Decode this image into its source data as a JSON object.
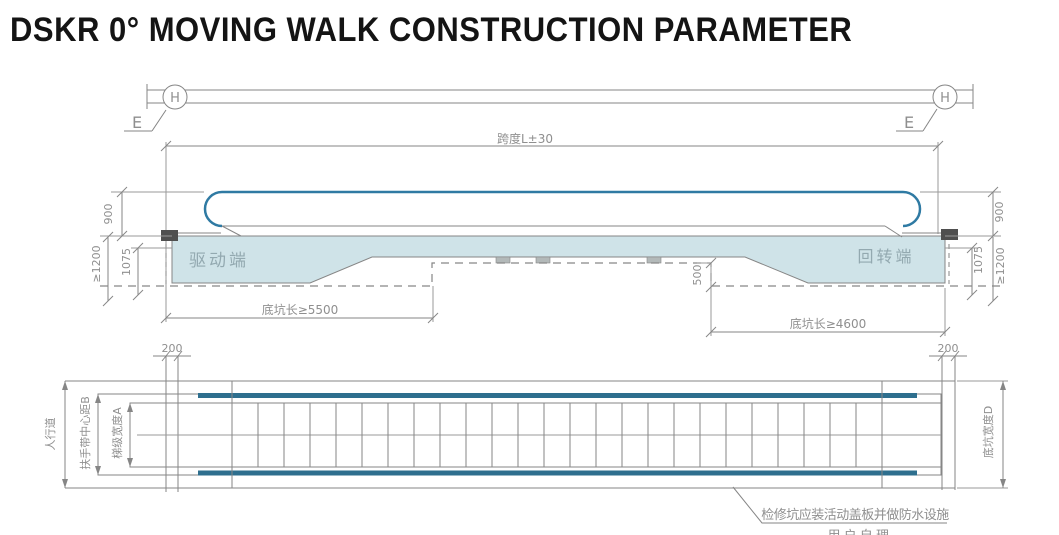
{
  "title": "DSKR 0° MOVING WALK CONSTRUCTION PARAMETER",
  "colors": {
    "line_gray": "#868686",
    "handrail_teal": "#2f7aa3",
    "truss_fill": "#cfe3e8",
    "belt_teal": "#2e6f8e",
    "cn_label_gray": "#93a9b0",
    "title_black": "#141414"
  },
  "section_view": {
    "grid_bubble_left": "H",
    "grid_bubble_right": "H",
    "elev_mark_left": "E",
    "elev_mark_right": "E",
    "span_dim": "跨度L±30",
    "handrail_height_left": "900",
    "handrail_height_right": "900",
    "pit_depth_left": "≥1200",
    "pit_depth_right": "≥1200",
    "inner_depth_left": "1075",
    "inner_depth_right": "1075",
    "step_depth_dim": "500",
    "drive_end_label": "驱动端",
    "return_end_label": "回转端",
    "pit_length_drive": "底坑长≥5500",
    "pit_length_return": "底坑长≥4600"
  },
  "plan_view": {
    "offset_left": "200",
    "offset_right": "200",
    "walkway_label": "人行道",
    "handrail_center_label": "扶手带中心距B",
    "step_width_label": "梯级宽度A",
    "pit_width_label": "底坑宽度D",
    "note_line1": "检修坑应装活动盖板并做防水设施",
    "note_line2": "用 户 自 理"
  }
}
